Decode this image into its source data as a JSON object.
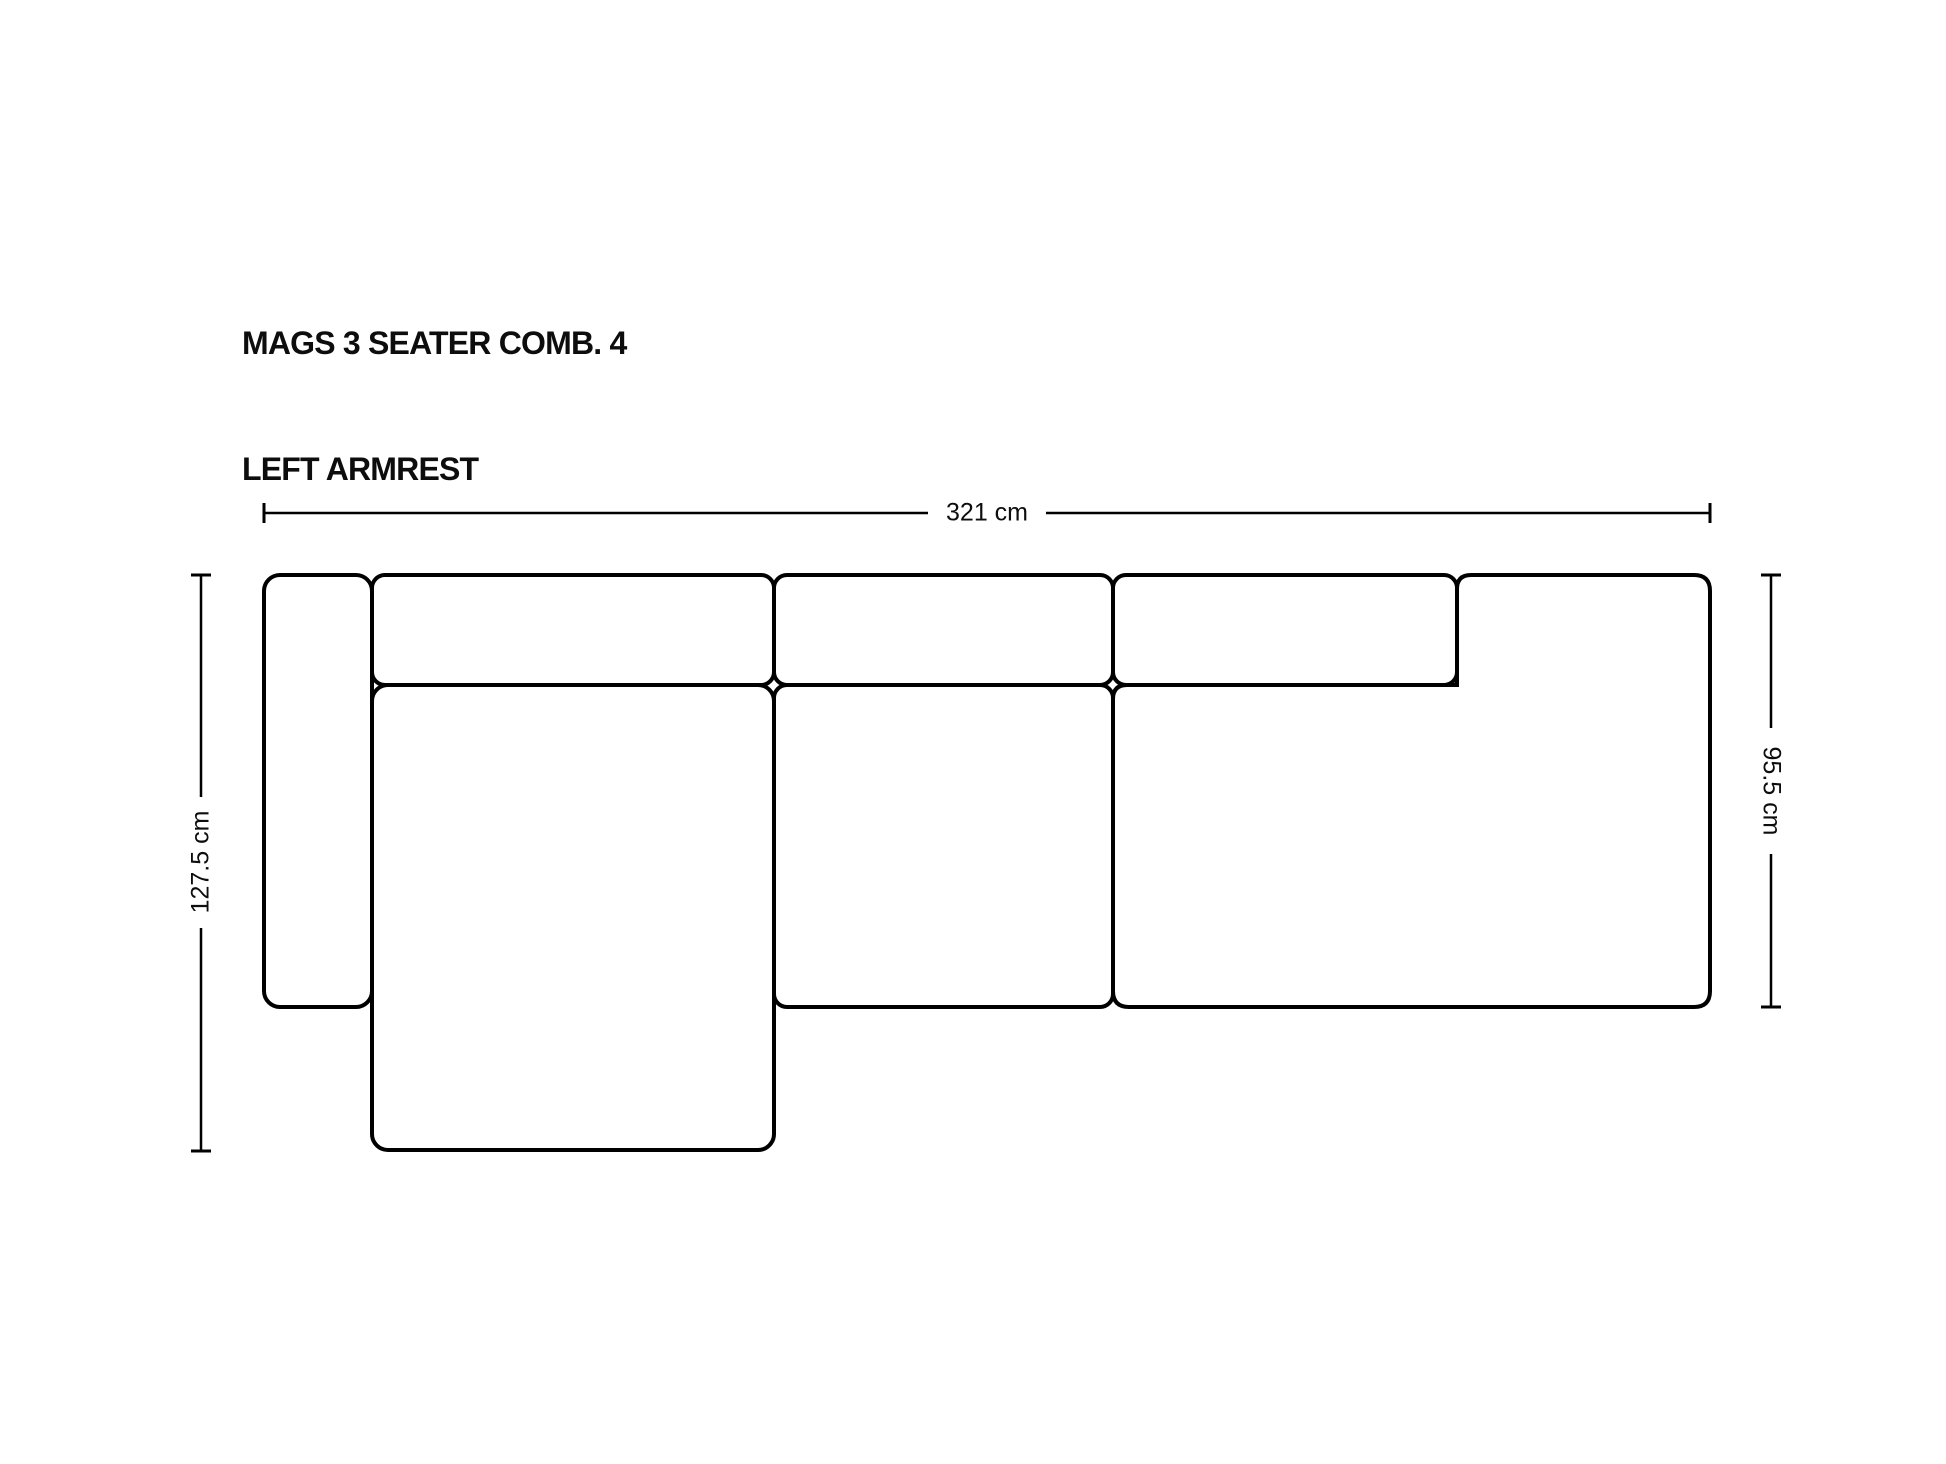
{
  "page": {
    "background_color": "#ffffff",
    "line_color": "#000000",
    "text_color": "#0d0d0d"
  },
  "title": {
    "line1": "MAGS 3 SEATER COMB. 4",
    "line2": "LEFT ARMREST"
  },
  "dimensions": {
    "overall_width": {
      "label": "321 cm",
      "orientation": "horizontal"
    },
    "chaise_depth": {
      "label": "127.5 cm",
      "orientation": "vertical-left"
    },
    "sofa_depth": {
      "label": "95.5 cm",
      "orientation": "vertical-right"
    }
  },
  "drawing": {
    "view": "top-down outline of modular sofa",
    "parts": [
      {
        "name": "left-armrest"
      },
      {
        "name": "back-cushion-1"
      },
      {
        "name": "back-cushion-2"
      },
      {
        "name": "back-cushion-3"
      },
      {
        "name": "chaise-longue-seat"
      },
      {
        "name": "middle-seat"
      },
      {
        "name": "right-lounge-module"
      }
    ]
  }
}
